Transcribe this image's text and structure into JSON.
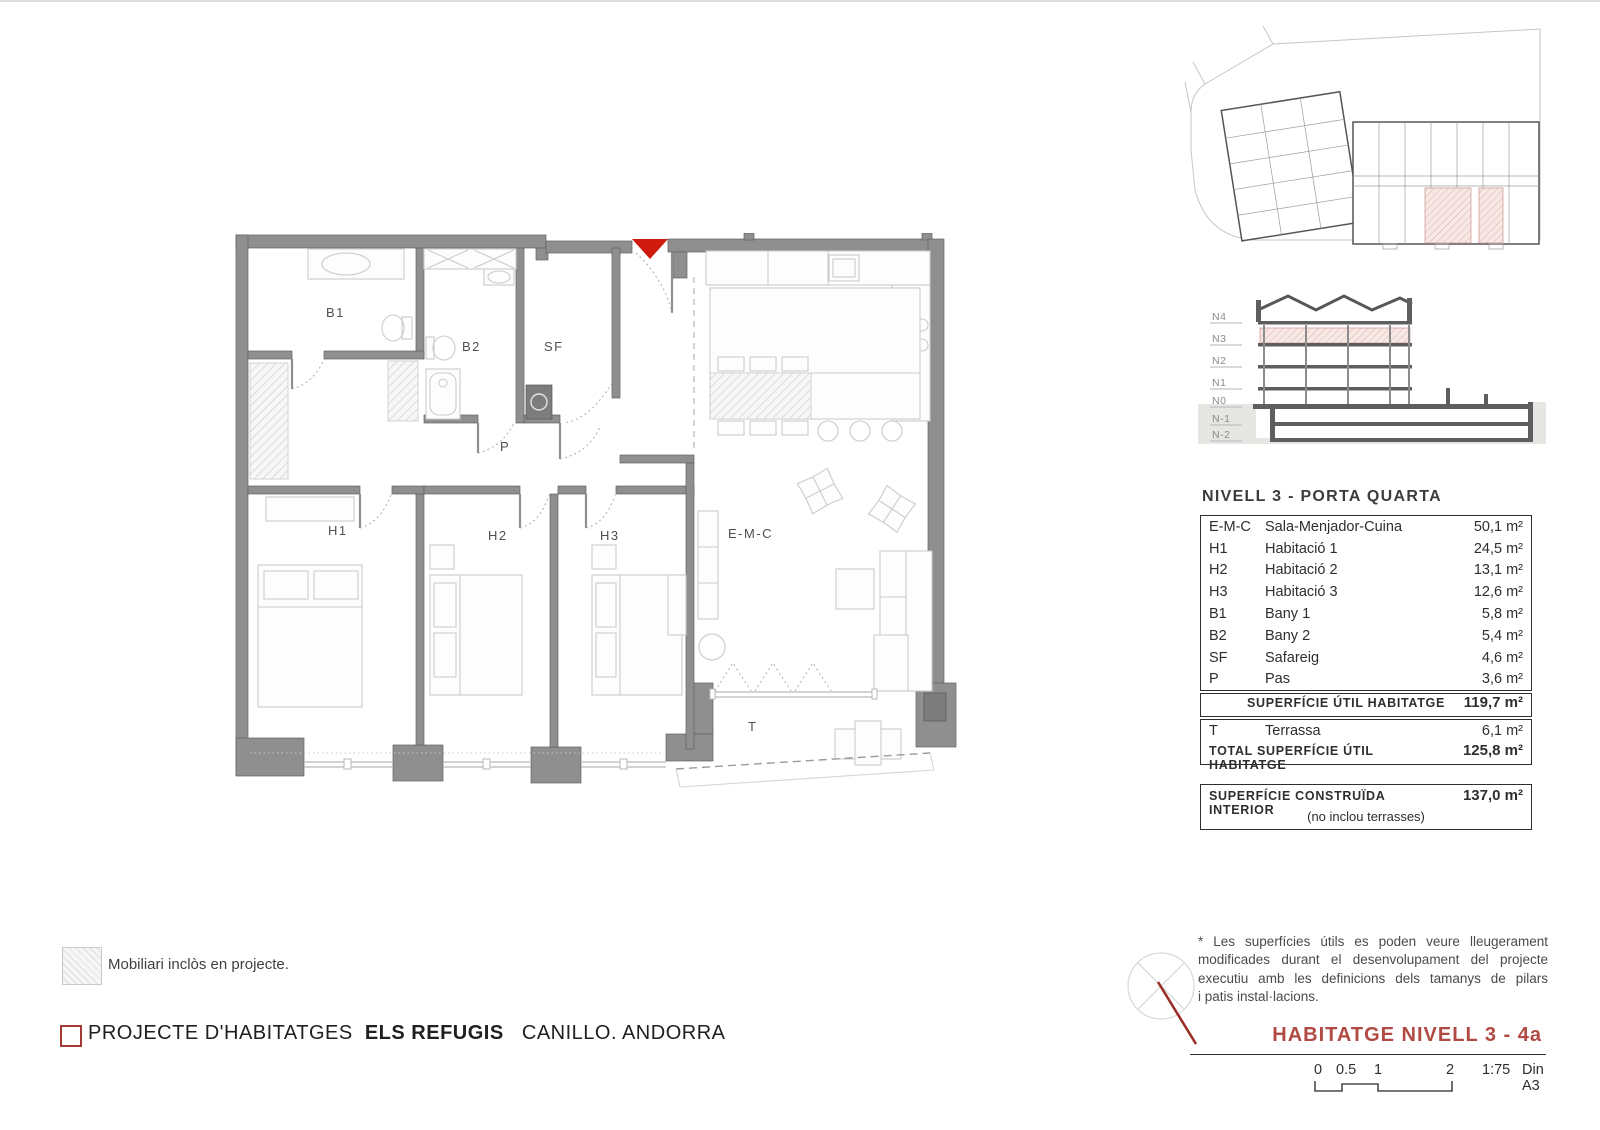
{
  "colors": {
    "wall_gray": "#8f8f8f",
    "accent_red": "#cf1a0e",
    "title_red": "#b04a42",
    "pink_highlight": "#f3e0dd",
    "text_dark": "#2e2e2e"
  },
  "plan": {
    "labels": {
      "b1": "B1",
      "b2": "B2",
      "sf": "SF",
      "p": "P",
      "h1": "H1",
      "h2": "H2",
      "h3": "H3",
      "emc": "E-M-C",
      "t": "T"
    }
  },
  "section": {
    "levels": [
      "N4",
      "N3",
      "N2",
      "N1",
      "N0",
      "N-1",
      "N-2"
    ]
  },
  "area_table": {
    "title": "NIVELL 3 - PORTA QUARTA",
    "rows": [
      {
        "code": "E-M-C",
        "name": "Sala-Menjador-Cuina",
        "area": "50,1 m²"
      },
      {
        "code": "H1",
        "name": "Habitació 1",
        "area": "24,5 m²"
      },
      {
        "code": "H2",
        "name": "Habitació 2",
        "area": "13,1 m²"
      },
      {
        "code": "H3",
        "name": "Habitació 3",
        "area": "12,6 m²"
      },
      {
        "code": "B1",
        "name": "Bany 1",
        "area": "5,8 m²"
      },
      {
        "code": "B2",
        "name": "Bany 2",
        "area": "5,4 m²"
      },
      {
        "code": "SF",
        "name": "Safareig",
        "area": "4,6 m²"
      },
      {
        "code": "P",
        "name": "Pas",
        "area": "3,6 m²"
      }
    ],
    "subtotal_label": "SUPERFÍCIE ÚTIL HABITATGE",
    "subtotal_value": "119,7 m²",
    "terrace_row": {
      "code": "T",
      "name": "Terrassa",
      "area": "6,1 m²"
    },
    "total_label": "TOTAL SUPERFÍCIE ÚTIL HABITATGE",
    "total_value": "125,8 m²",
    "built_label": "SUPERFÍCIE CONSTRUÏDA INTERIOR",
    "built_value": "137,0 m²",
    "built_note": "(no inclou terrasses)"
  },
  "legend": {
    "furniture_note": "Mobiliari inclòs en projecte."
  },
  "note": {
    "lines": [
      "* Les superfícies útils es poden veure lleugerament",
      "modificades durant el desenvolupament del projecte",
      "executiu amb les definicions dels tamanys de pilars",
      "i patis instal·lacions."
    ]
  },
  "titlebar": {
    "project": "PROJECTE  D'HABITATGES",
    "project_bold": "ELS REFUGIS",
    "location": "CANILLO. ANDORRA"
  },
  "sheet": {
    "title": "HABITATGE  NIVELL 3 - 4a",
    "scale_marks": [
      "0",
      "0.5",
      "1",
      "2"
    ],
    "scale_ratio": "1:75",
    "paper": "Din A3"
  }
}
